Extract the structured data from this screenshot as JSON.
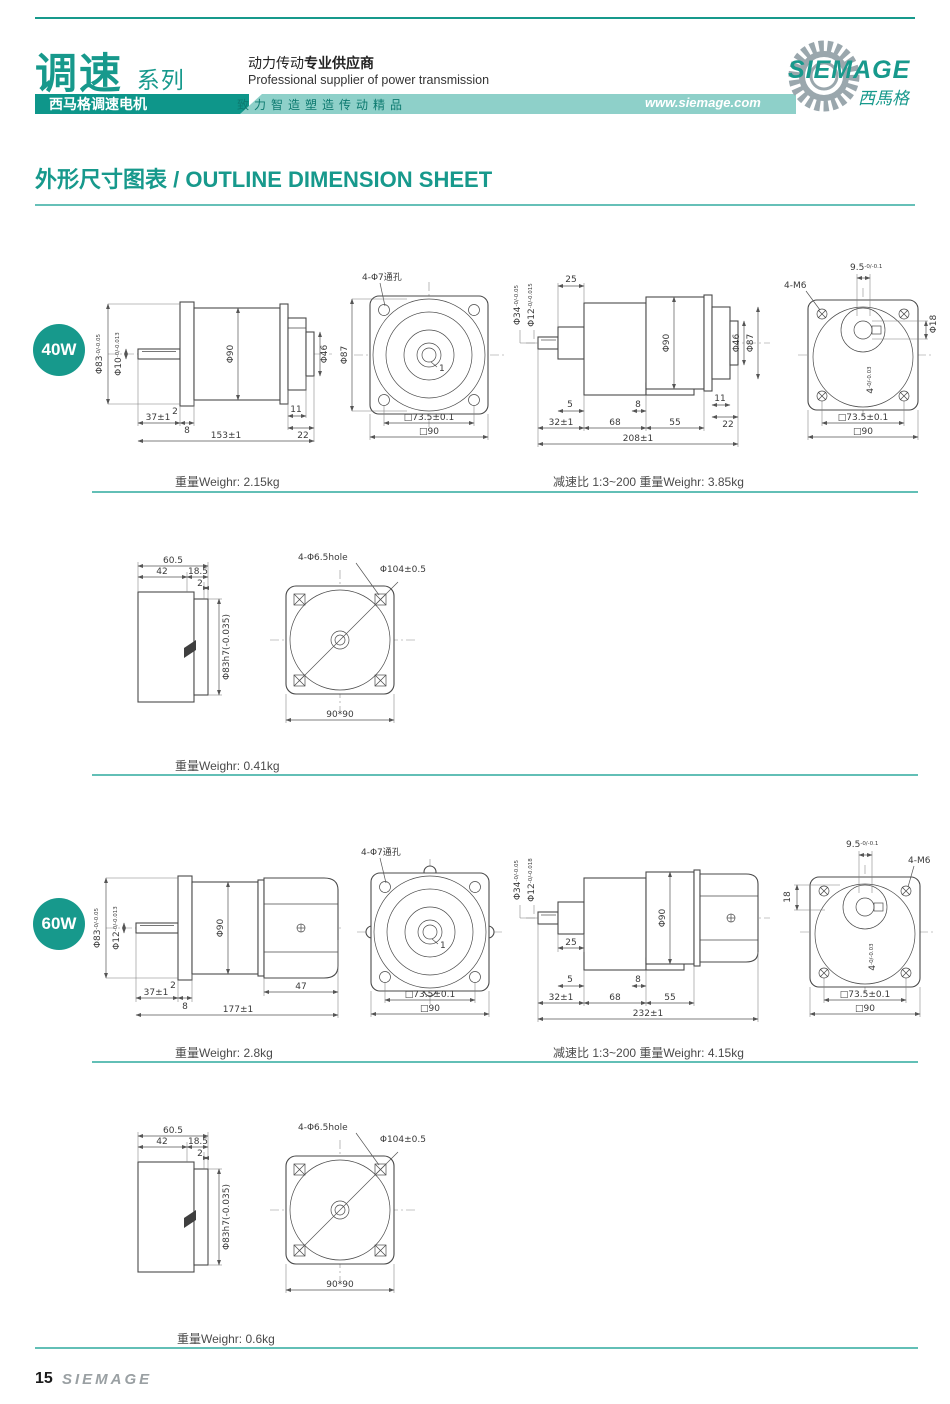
{
  "header": {
    "series": "调速",
    "series_sub": "系列",
    "tab": "西马格调速电机",
    "tagline_cn": "动力传动",
    "tagline_cn_bold": "专业供应商",
    "tagline_en": "Professional supplier of power transmission",
    "slogan": "致力智造塑造传动精品",
    "website": "www.siemage.com",
    "logo": "SIEMAGE",
    "logo_cn": "西馬格"
  },
  "title": "外形尺寸图表 / OUTLINE DIMENSION SHEET",
  "m40": {
    "badge": "40W",
    "side": {
      "d83": "Φ83",
      "d83t": "-0/-0.05",
      "dsh": "Φ10",
      "dsht": "-0/-0.013",
      "body": "Φ90",
      "d46": "Φ46",
      "b2": "2",
      "b37": "37±1",
      "b8": "8",
      "b11": "11",
      "b22": "22",
      "total": "153±1"
    },
    "front": {
      "holes": "4-Φ7通孔",
      "d87": "Φ87",
      "key": "1",
      "sq1": "□73.5±0.1",
      "sq2": "□90"
    },
    "gear": {
      "d34": "Φ34",
      "d34t": "-0/-0.05",
      "d12": "Φ12",
      "d12t": "-0/-0.015",
      "t25": "25",
      "body": "Φ90",
      "d46": "Φ46",
      "d87": "Φ87",
      "b5": "5",
      "b8": "8",
      "b11": "11",
      "b22": "22",
      "c32": "32±1",
      "c68": "68",
      "c55": "55",
      "total": "208±1"
    },
    "rear": {
      "m6": "4-M6",
      "top": "9.5",
      "topt": "-0/-0.1",
      "d18": "Φ18",
      "key": "4",
      "keyt": "-0/-0.03",
      "sq1": "□73.5±0.1",
      "sq2": "□90"
    },
    "w1": "重量Weighr: 2.15kg",
    "w2": "减速比 1:3~200  重量Weighr: 3.85kg"
  },
  "fan40": {
    "side": {
      "t605": "60.5",
      "t42": "42",
      "t185": "18.5",
      "t2": "2",
      "dia": "Φ83h7(-0.035)"
    },
    "front": {
      "holes": "4-Φ6.5hole",
      "dia": "Φ104±0.5",
      "sq": "90*90"
    },
    "w": "重量Weighr: 0.41kg"
  },
  "m60": {
    "badge": "60W",
    "side": {
      "d83": "Φ83",
      "d83t": "-0/-0.05",
      "dsh": "Φ12",
      "dsht": "-0/-0.013",
      "body": "Φ90",
      "b2": "2",
      "b37": "37±1",
      "b8": "8",
      "b47": "47",
      "total": "177±1"
    },
    "front": {
      "holes": "4-Φ7通孔",
      "key": "1",
      "sq1": "□73.5±0.1",
      "sq2": "□90"
    },
    "gear": {
      "d34": "Φ34",
      "d34t": "-0/-0.05",
      "d12": "Φ12",
      "d12t": "-0/-0.018",
      "t25": "25",
      "body": "Φ90",
      "b5": "5",
      "b8": "8",
      "c32": "32±1",
      "c68": "68",
      "c55": "55",
      "total": "232±1"
    },
    "rear": {
      "m6": "4-M6",
      "top": "9.5",
      "topt": "-0/-0.1",
      "d18": "18",
      "key": "4",
      "keyt": "-0/-0.03",
      "sq1": "□73.5±0.1",
      "sq2": "□90"
    },
    "w1": "重量Weighr: 2.8kg",
    "w2": "减速比 1:3~200  重量Weighr: 4.15kg"
  },
  "fan60": {
    "side": {
      "t605": "60.5",
      "t42": "42",
      "t185": "18.5",
      "t2": "2",
      "dia": "Φ83h7(-0.035)"
    },
    "front": {
      "holes": "4-Φ6.5hole",
      "dia": "Φ104±0.5",
      "sq": "90*90"
    },
    "w": "重量Weighr: 0.6kg"
  },
  "footer": {
    "page": "15",
    "brand": "SIEMAGE"
  }
}
